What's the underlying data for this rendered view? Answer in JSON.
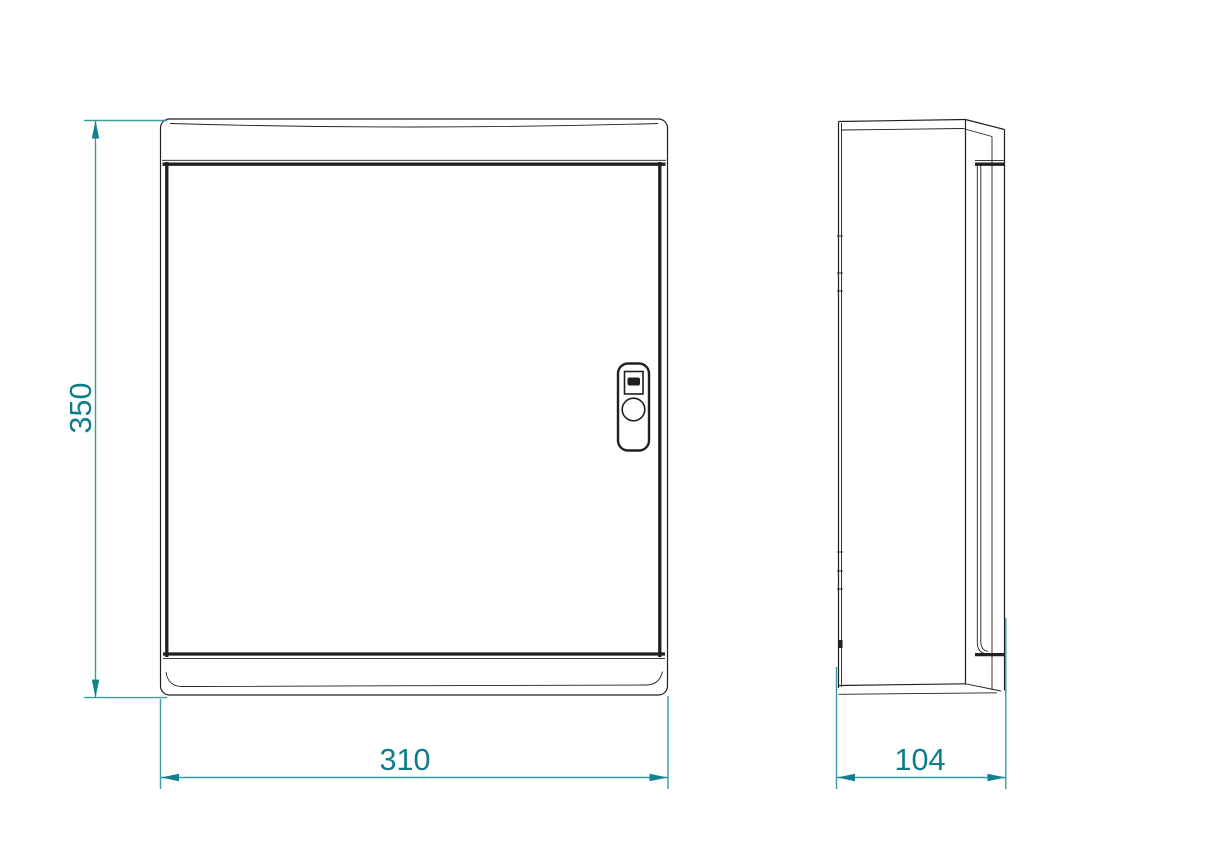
{
  "theme": {
    "line_color": "#202020",
    "dim_line_color": "#399ba4",
    "dim_arrow_color": "#14808d",
    "dim_text_color": "#0e7d8b",
    "background_color": "#ffffff"
  },
  "drawing": {
    "kind": "technical-drawing",
    "subject": "wall-mounted enclosure, orthographic front and side views",
    "views": [
      {
        "id": "front-view",
        "description": "front elevation with hinged door and lock"
      },
      {
        "id": "side-view",
        "description": "side profile with mounting back and groove"
      }
    ],
    "dimensions": [
      {
        "id": "height",
        "value": "350",
        "orientation": "vertical",
        "view": "front-view"
      },
      {
        "id": "width",
        "value": "310",
        "orientation": "horizontal",
        "view": "front-view"
      },
      {
        "id": "depth",
        "value": "104",
        "orientation": "horizontal",
        "view": "side-view"
      }
    ]
  }
}
